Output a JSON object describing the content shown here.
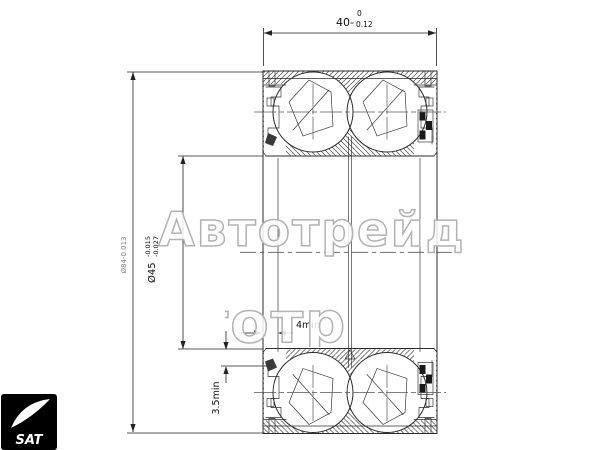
{
  "dimensions": {
    "width": {
      "prefix": "40-",
      "upper": "0",
      "lower": "0.12"
    },
    "bore": {
      "base": "Ø45",
      "upper": "-0.015",
      "lower": "-0.027"
    },
    "outer_diameter_faint": "Ø84-0.013",
    "recess_min": "4min",
    "seal_depth_min": "3.5min"
  },
  "watermark": {
    "row1": "Автотрейд",
    "row2": "Автотрейд"
  },
  "logo": {
    "text": "SAT"
  },
  "colors": {
    "background": "#ffffff",
    "line": "#2b2b2b",
    "dimension": "#222222",
    "watermark_stroke": "#b2b2b2",
    "logo_bg": "#000000"
  }
}
